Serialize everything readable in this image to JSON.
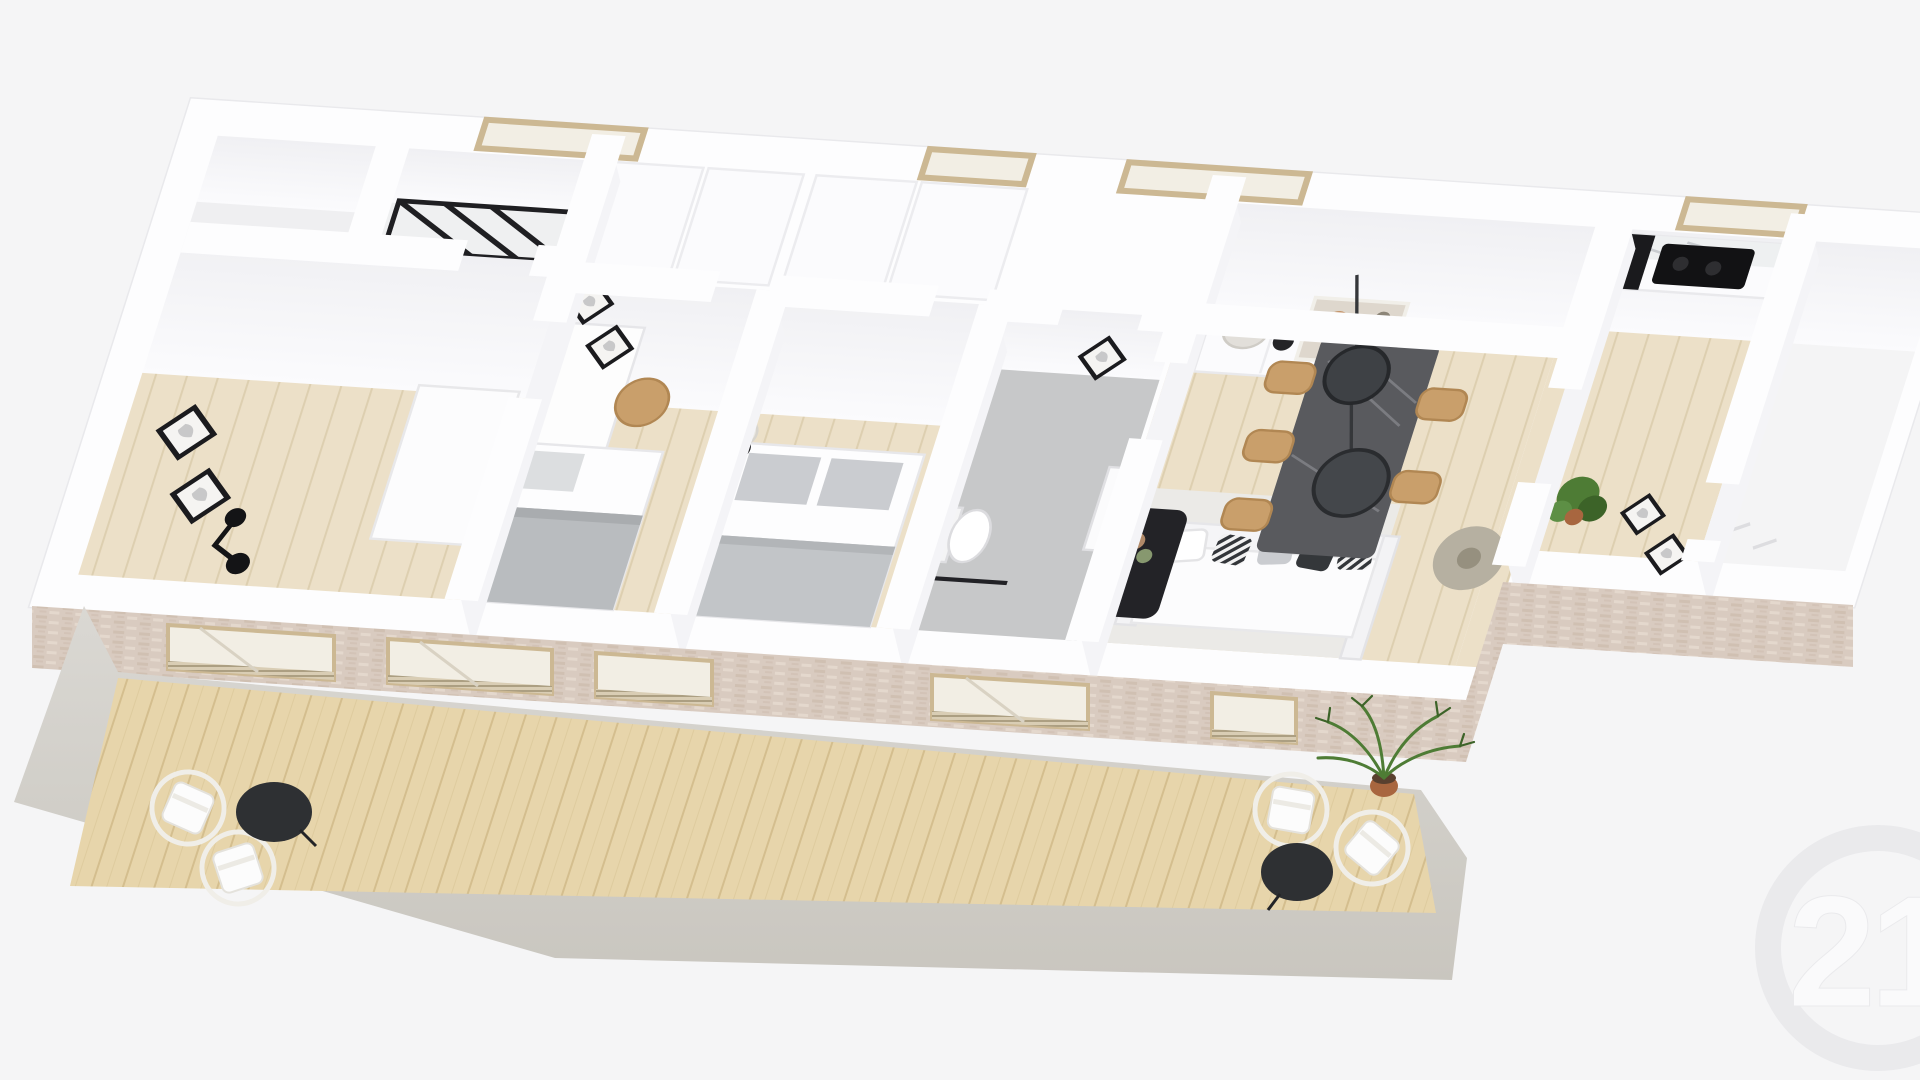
{
  "meta": {
    "type": "3d-floor-plan-render",
    "view": "isometric dollhouse cutaway seen from above-front",
    "description": "Photorealistic 3D render of a single-storey apartment floor plan with white interior walls, light wood floors, staged furniture, a pale pink brick street facade with glazed openings, and a long wooden-deck balcony with a concrete rim. Faint Century 21 watermark in the lower right corner."
  },
  "watermark": {
    "brand": "Century 21",
    "text": "21"
  },
  "palette": {
    "bg": "#f5f5f6",
    "wall_white": "#fdfdfe",
    "wall_edge": "#e9e9ec",
    "wall_face": "#f4f4f7",
    "wood_floor": "#ece0c8",
    "wood_floor_line": "#ddcfb0",
    "deck_wood": "#e7d5ab",
    "deck_line": "#d4be8e",
    "concrete": "#dad8d3",
    "concrete_dark": "#c9c6bf",
    "brick": "#d9cbc0",
    "brick_dark": "#c8b5a6",
    "brick_light": "#e7dbd1",
    "frame_beige": "#cdb astaxanthin",
    "beige_frame": "#ccb893",
    "glass": "#f2eee4",
    "tile_gray": "#c7c8c9",
    "black": "#232327",
    "textile_gray": "#b9bcbf",
    "pillow_gray": "#caccd0",
    "tan_wood": "#c99f6b",
    "marble_dark": "#595a5e",
    "marble_streak": "#83858a",
    "rug": "#ebeae7",
    "green_plant": "#4e7c35",
    "green_dark": "#3c6328",
    "terracotta": "#a8663f",
    "pendant_gray": "#b6b0a1",
    "watermark_gray": "#e9e9ec",
    "watermark_light": "#fbfbfc"
  },
  "scene": {
    "rooms": [
      {
        "name": "storage-cell-a",
        "furniture": []
      },
      {
        "name": "storage-cell-b",
        "furniture": [
          "black-metal-shelf"
        ]
      },
      {
        "name": "entry-hall",
        "furniture": [
          "two-wall-frames",
          "black-wall-lamp",
          "white-wardrobe"
        ]
      },
      {
        "name": "bedroom-1",
        "furniture": [
          "white-desk",
          "tan-chair",
          "two-wall-frames",
          "single-bed-gray-blanket"
        ]
      },
      {
        "name": "bedroom-2",
        "furniture": [
          "double-bed-gray-pillows",
          "bedside-lamp",
          "back-closets"
        ]
      },
      {
        "name": "bathroom",
        "furniture": [
          "wall-hung-toilet",
          "glass-shower",
          "radiator",
          "black-frame-mirror"
        ]
      },
      {
        "name": "living-dining",
        "furniture": [
          "white-sofa",
          "throw-pillows",
          "black-coffee-table",
          "area-rug",
          "white-sideboard",
          "decor-vases",
          "leaning-artwork",
          "black-table-lamp",
          "dark-marble-dining-table",
          "wooden-dining-chairs",
          "two-black-pendant-lamps",
          "gray-disc-pendant"
        ]
      },
      {
        "name": "kitchen",
        "furniture": [
          "white-counter-marble-top",
          "black-cooktop",
          "black-oven-column",
          "potted-plant",
          "two-wall-frames"
        ]
      },
      {
        "name": "bedroom-3-empty",
        "furniture": []
      }
    ],
    "back_wall_windows": 4,
    "facade": {
      "material": "pale pink brick",
      "glazed_openings": 5,
      "vent_grilles": true
    },
    "balcony": {
      "floor": "wood deck",
      "border": "concrete rim",
      "items": [
        "bistro-set-left: 2 white chairs + black round table",
        "bistro-set-right: 2 white chairs + black round table",
        "potted-palm-terracotta"
      ]
    }
  }
}
